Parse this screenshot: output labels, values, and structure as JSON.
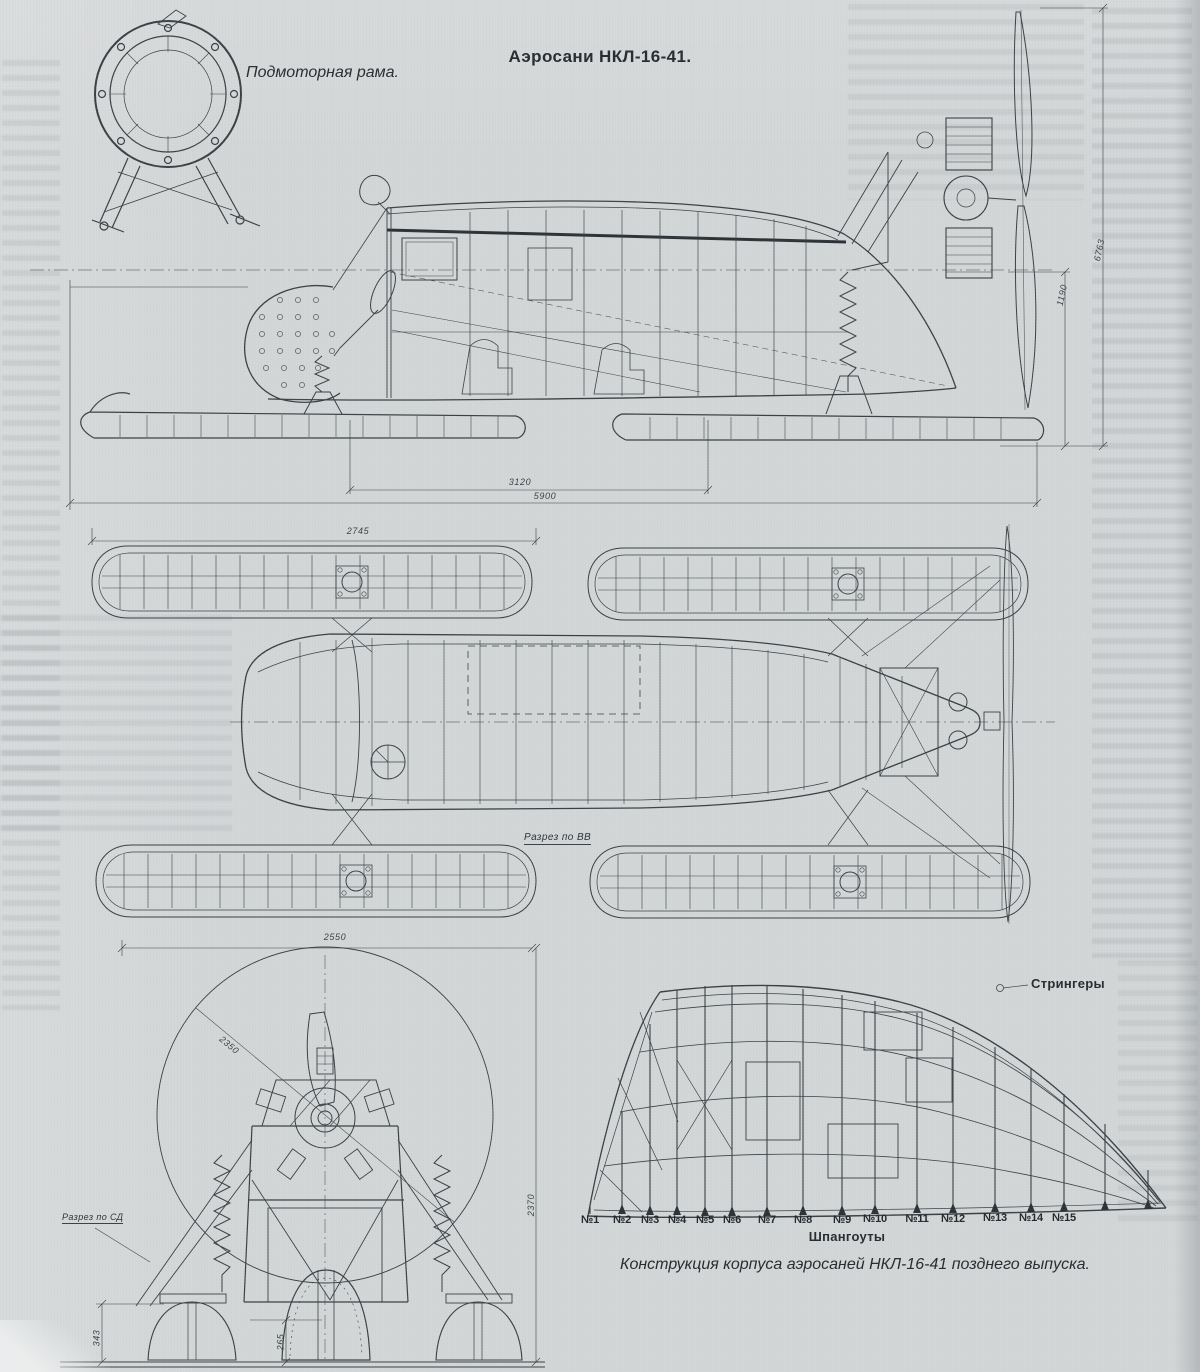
{
  "page": {
    "title": "Аэросани НКЛ-16-41.",
    "caption": "Конструкция корпуса аэросаней НКЛ-16-41 позднего выпуска.",
    "background_color": "#d3d6d7",
    "ink_color": "#3a4044"
  },
  "labels": {
    "motor_frame": "Подмоторная рама.",
    "section_vv": "Разрез по ВВ",
    "section_sd": "Разрез по СД",
    "stringers": "Стрингеры",
    "frames_axis": "Шпангоуты"
  },
  "dimensions": {
    "plan_ski_length": "2745",
    "side_ski_base": "3120",
    "side_overall_length": "5900",
    "side_overall_height": "6763",
    "side_rear_height": "1190",
    "front_track": "2550",
    "front_overall_height": "2370",
    "front_ski_height": "343",
    "front_center_ski_height": "265",
    "front_prop_diameter": "2350"
  },
  "frame_numbers": [
    "№1",
    "№2",
    "№3",
    "№4",
    "№5",
    "№6",
    "№7",
    "№8",
    "№9",
    "№10",
    "№11",
    "№12",
    "№13",
    "№14",
    "№15"
  ]
}
